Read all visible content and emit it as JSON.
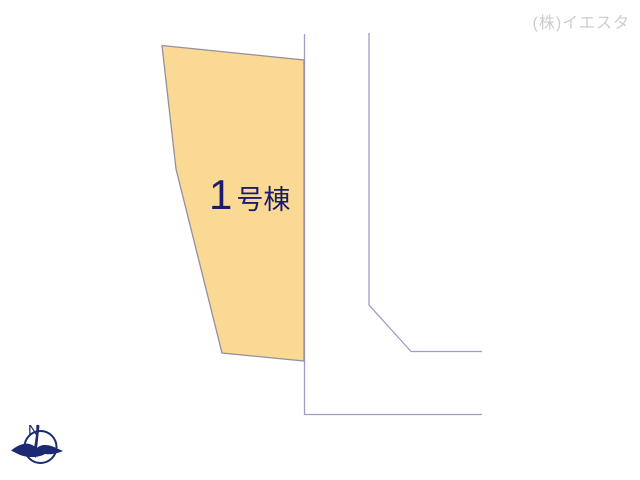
{
  "watermark": {
    "text": "(株)イエスタ"
  },
  "lot": {
    "label_number": "1",
    "label_suffix": "号棟"
  },
  "compass": {
    "north_label": "N"
  },
  "colors": {
    "lot_fill": "#F9D993",
    "lot_border": "#968FA0",
    "road_line": "#9D9DC6",
    "label_text": "#1C1C6E",
    "compass": "#1B2A72",
    "watermark_text": "#CDCDCD"
  }
}
